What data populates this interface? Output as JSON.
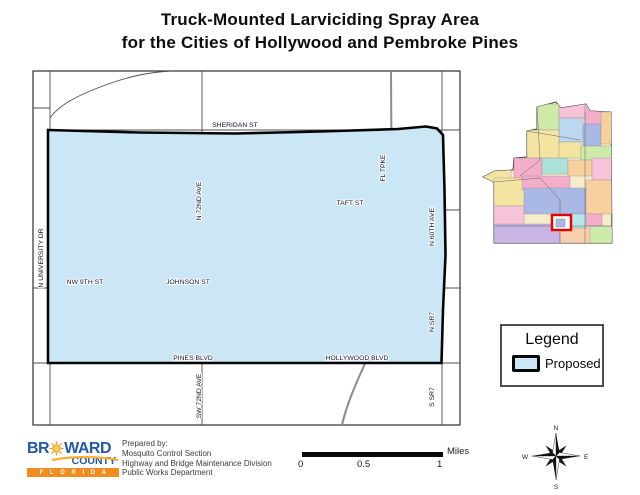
{
  "title": {
    "line1": "Truck-Mounted Larviciding Spray Area",
    "line2": "for the Cities of Hollywood and Pembroke Pines"
  },
  "map": {
    "proposed_area_color": "#cbe6f5",
    "street_labels": {
      "sheridan": "SHERIDAN ST",
      "fl_tpke": "FL TPKE",
      "taft": "TAFT ST",
      "n_60th_ave": "N 60TH AVE",
      "n_72nd_ave": "N 72ND AVE",
      "n_university_dr": "N UNIVERSITY DR",
      "nw_9th_st": "NW 9TH ST",
      "johnson_st": "JOHNSON ST",
      "pines_blvd": "PINES BLVD",
      "hollywood_blvd": "HOLLYWOOD BLVD",
      "sw_72nd_ave": "SW 72ND AVE",
      "n_sr7": "N SR7",
      "s_sr7": "S SR7"
    }
  },
  "inset": {
    "highlight_color": "#e60000",
    "palette": [
      "#f4e4a2",
      "#f2aecb",
      "#f6c3d8",
      "#bcd8f0",
      "#aab8e6",
      "#cdeaa8",
      "#f8d0a0",
      "#ade2d8",
      "#c9b4e4",
      "#f8cfae",
      "#b8e4ee"
    ]
  },
  "legend": {
    "title": "Legend",
    "items": [
      {
        "label": "Proposed",
        "fill": "#cbe6f5",
        "outline": "#000000"
      }
    ]
  },
  "scale_bar": {
    "unit_label": "Miles",
    "ticks": [
      "0",
      "0.5",
      "1"
    ]
  },
  "compass": {
    "n": "N",
    "s": "S",
    "e": "E",
    "w": "W"
  },
  "credits": {
    "logo_name_prefix": "BR",
    "logo_name_suffix": "WARD",
    "logo_county": "COUNTY",
    "logo_state": "F L O R I D A",
    "prepared_by": "Prepared by:",
    "lines": [
      "Mosquito Control Section",
      "Highway and Bridge Maintenance Division",
      "Public Works Department"
    ]
  }
}
